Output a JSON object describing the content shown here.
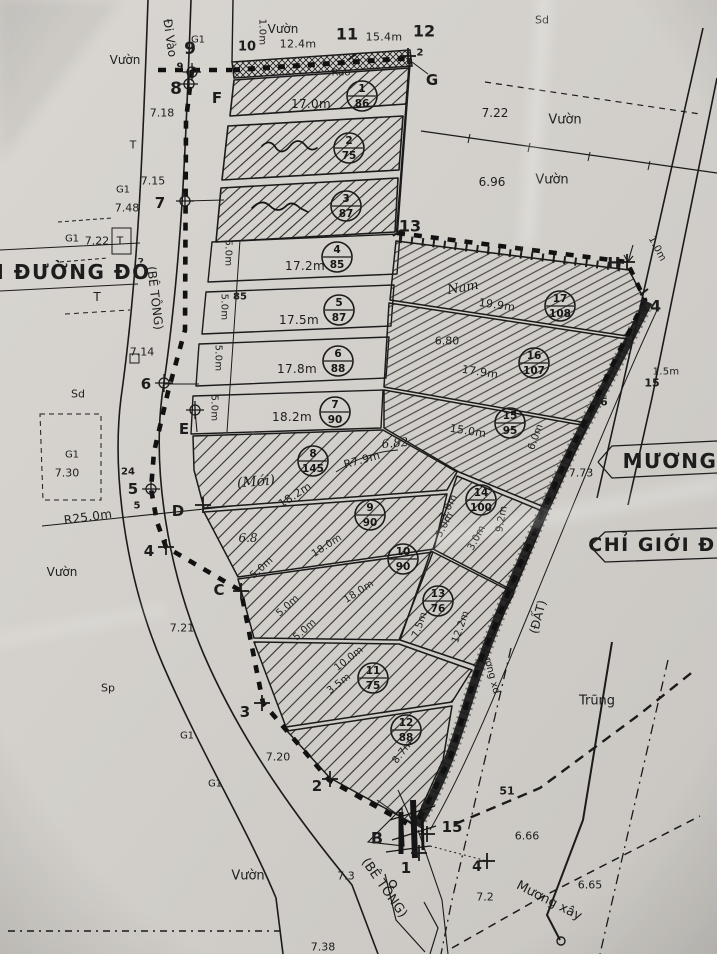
{
  "map": {
    "ink": "#1b1b1b",
    "paper": "#d3d0cb",
    "plots": [
      {
        "n": "1",
        "a": "86",
        "x": 362,
        "y": 96
      },
      {
        "n": "2",
        "a": "75",
        "x": 349,
        "y": 148
      },
      {
        "n": "3",
        "a": "87",
        "x": 346,
        "y": 206
      },
      {
        "n": "4",
        "a": "85",
        "x": 337,
        "y": 257
      },
      {
        "n": "5",
        "a": "87",
        "x": 339,
        "y": 310
      },
      {
        "n": "6",
        "a": "88",
        "x": 338,
        "y": 361
      },
      {
        "n": "7",
        "a": "90",
        "x": 335,
        "y": 412
      },
      {
        "n": "8",
        "a": "145",
        "x": 313,
        "y": 461
      },
      {
        "n": "9",
        "a": "90",
        "x": 370,
        "y": 515
      },
      {
        "n": "10",
        "a": "90",
        "x": 403,
        "y": 559
      },
      {
        "n": "11",
        "a": "75",
        "x": 373,
        "y": 678
      },
      {
        "n": "12",
        "a": "88",
        "x": 406,
        "y": 730
      },
      {
        "n": "13",
        "a": "76",
        "x": 438,
        "y": 601
      },
      {
        "n": "14",
        "a": "100",
        "x": 481,
        "y": 500
      },
      {
        "n": "15",
        "a": "95",
        "x": 510,
        "y": 423
      },
      {
        "n": "16",
        "a": "107",
        "x": 534,
        "y": 363
      },
      {
        "n": "17",
        "a": "108",
        "x": 560,
        "y": 306
      }
    ],
    "labels": [
      {
        "t": "9",
        "x": 190,
        "y": 49,
        "s": 17,
        "c": "pt"
      },
      {
        "t": "8",
        "x": 176,
        "y": 89,
        "s": 17,
        "c": "pt"
      },
      {
        "t": "F",
        "x": 217,
        "y": 98,
        "s": 15,
        "c": "pt"
      },
      {
        "t": "10",
        "x": 247,
        "y": 47,
        "s": 13,
        "c": "pt"
      },
      {
        "t": "11",
        "x": 347,
        "y": 34,
        "s": 16,
        "c": "pt"
      },
      {
        "t": "12",
        "x": 424,
        "y": 31,
        "s": 16,
        "c": "pt"
      },
      {
        "t": "G",
        "x": 432,
        "y": 80,
        "s": 15,
        "c": "pt"
      },
      {
        "t": "13",
        "x": 410,
        "y": 226,
        "s": 16,
        "c": "pt"
      },
      {
        "t": "H",
        "x": 614,
        "y": 263,
        "s": 16,
        "c": "pt"
      },
      {
        "t": "14",
        "x": 650,
        "y": 306,
        "s": 16,
        "c": "pt"
      },
      {
        "t": "7",
        "x": 160,
        "y": 203,
        "s": 15,
        "c": "pt"
      },
      {
        "t": "6",
        "x": 146,
        "y": 384,
        "s": 15,
        "c": "pt"
      },
      {
        "t": "E",
        "x": 184,
        "y": 429,
        "s": 15,
        "c": "pt"
      },
      {
        "t": "5",
        "x": 133,
        "y": 489,
        "s": 15,
        "c": "pt"
      },
      {
        "t": "D",
        "x": 178,
        "y": 511,
        "s": 15,
        "c": "pt"
      },
      {
        "t": "4",
        "x": 149,
        "y": 551,
        "s": 15,
        "c": "pt"
      },
      {
        "t": "C",
        "x": 219,
        "y": 590,
        "s": 15,
        "c": "pt"
      },
      {
        "t": "3",
        "x": 245,
        "y": 712,
        "s": 15,
        "c": "pt"
      },
      {
        "t": "2",
        "x": 317,
        "y": 786,
        "s": 15,
        "c": "pt"
      },
      {
        "t": "B",
        "x": 377,
        "y": 838,
        "s": 16,
        "c": "pt"
      },
      {
        "t": "1",
        "x": 406,
        "y": 868,
        "s": 15,
        "c": "pt"
      },
      {
        "t": "15",
        "x": 452,
        "y": 827,
        "s": 15,
        "c": "pt"
      },
      {
        "t": "4",
        "x": 477,
        "y": 867,
        "s": 14,
        "c": "pt"
      },
      {
        "t": "9",
        "x": 180,
        "y": 67,
        "s": 10,
        "c": "sm"
      },
      {
        "t": "2",
        "x": 420,
        "y": 53,
        "s": 10,
        "c": "sm"
      },
      {
        "t": "5",
        "x": 137,
        "y": 506,
        "s": 10,
        "c": "sm"
      },
      {
        "t": "24",
        "x": 128,
        "y": 472,
        "s": 10,
        "c": "sm"
      },
      {
        "t": "85",
        "x": 240,
        "y": 297,
        "s": 10,
        "c": "sm"
      },
      {
        "t": "51",
        "x": 507,
        "y": 791,
        "s": 11,
        "c": "sm"
      },
      {
        "t": "15",
        "x": 652,
        "y": 383,
        "s": 11,
        "c": "sm"
      },
      {
        "t": "66",
        "x": 600,
        "y": 402,
        "s": 11,
        "c": "sm"
      },
      {
        "t": "Vườn",
        "x": 125,
        "y": 60,
        "s": 12,
        "c": "name"
      },
      {
        "t": "Vườn",
        "x": 283,
        "y": 29,
        "s": 12,
        "c": "name"
      },
      {
        "t": "Vườn",
        "x": 565,
        "y": 120,
        "s": 13,
        "c": "name"
      },
      {
        "t": "Vườn",
        "x": 552,
        "y": 180,
        "s": 13,
        "c": "name"
      },
      {
        "t": "Vườn",
        "x": 62,
        "y": 572,
        "s": 12,
        "c": "name"
      },
      {
        "t": "Vườn",
        "x": 248,
        "y": 876,
        "s": 13,
        "c": "name"
      },
      {
        "t": "Trũng",
        "x": 597,
        "y": 701,
        "s": 13,
        "c": "name"
      },
      {
        "t": "Sd",
        "x": 542,
        "y": 20,
        "s": 11,
        "c": "name"
      },
      {
        "t": "Sd",
        "x": 78,
        "y": 394,
        "s": 11,
        "c": "name"
      },
      {
        "t": "Sp",
        "x": 108,
        "y": 688,
        "s": 11,
        "c": "name"
      },
      {
        "t": "Rào",
        "x": 341,
        "y": 73,
        "s": 10,
        "c": "name"
      },
      {
        "t": "G1",
        "x": 198,
        "y": 40,
        "s": 10,
        "c": "name"
      },
      {
        "t": "G1",
        "x": 123,
        "y": 190,
        "s": 10,
        "c": "name"
      },
      {
        "t": "G1",
        "x": 72,
        "y": 239,
        "s": 10,
        "c": "name"
      },
      {
        "t": "G1",
        "x": 72,
        "y": 455,
        "s": 10,
        "c": "name"
      },
      {
        "t": "G1",
        "x": 187,
        "y": 736,
        "s": 10,
        "c": "name"
      },
      {
        "t": "G1",
        "x": 215,
        "y": 784,
        "s": 10,
        "c": "name"
      },
      {
        "t": "T",
        "x": 133,
        "y": 145,
        "s": 11,
        "c": "name"
      },
      {
        "t": "T",
        "x": 120,
        "y": 241,
        "s": 11,
        "c": "name"
      },
      {
        "t": "T",
        "x": 97,
        "y": 297,
        "s": 12,
        "c": "name"
      },
      {
        "t": "Đi Vào",
        "x": 170,
        "y": 38,
        "s": 12,
        "r": 82,
        "c": "name"
      },
      {
        "t": "(BÊ TÔNG)",
        "x": 155,
        "y": 298,
        "s": 12,
        "r": 83,
        "c": "name"
      },
      {
        "t": "Mương xd",
        "x": 490,
        "y": 670,
        "s": 10,
        "r": 75,
        "c": "name"
      },
      {
        "t": "(ĐẤT)",
        "x": 538,
        "y": 617,
        "s": 12,
        "r": -75,
        "c": "name"
      },
      {
        "t": "Mương xây",
        "x": 549,
        "y": 901,
        "s": 13,
        "r": 27,
        "c": "name"
      },
      {
        "t": "(BÊ TÔNG)",
        "x": 384,
        "y": 888,
        "s": 13,
        "r": 55,
        "c": "name"
      },
      {
        "t": "ỚI ĐƯỜNG ĐỎ",
        "x": 64,
        "y": 272,
        "s": 20,
        "c": "big"
      },
      {
        "t": "MƯƠNG",
        "x": 670,
        "y": 461,
        "s": 20,
        "c": "big"
      },
      {
        "t": "CHỈ GIỚI Đ",
        "x": 652,
        "y": 545,
        "s": 19,
        "c": "big"
      },
      {
        "t": "7.18",
        "x": 162,
        "y": 113,
        "s": 11,
        "c": "elev"
      },
      {
        "t": "7.15",
        "x": 153,
        "y": 181,
        "s": 11,
        "c": "elev"
      },
      {
        "t": "7.48",
        "x": 127,
        "y": 208,
        "s": 11,
        "c": "elev"
      },
      {
        "t": "7.22",
        "x": 97,
        "y": 241,
        "s": 11,
        "c": "elev"
      },
      {
        "t": "7.14",
        "x": 142,
        "y": 352,
        "s": 11,
        "c": "elev"
      },
      {
        "t": "7.30",
        "x": 67,
        "y": 473,
        "s": 11,
        "c": "elev"
      },
      {
        "t": "7.21",
        "x": 182,
        "y": 628,
        "s": 11,
        "c": "elev"
      },
      {
        "t": "7.20",
        "x": 278,
        "y": 757,
        "s": 11,
        "c": "elev"
      },
      {
        "t": "7.22",
        "x": 495,
        "y": 113,
        "s": 12,
        "c": "elev"
      },
      {
        "t": "6.96",
        "x": 492,
        "y": 182,
        "s": 12,
        "c": "elev"
      },
      {
        "t": "6.80",
        "x": 447,
        "y": 341,
        "s": 11,
        "c": "elev"
      },
      {
        "t": "7.73",
        "x": 581,
        "y": 473,
        "s": 11,
        "c": "elev"
      },
      {
        "t": "6.66",
        "x": 527,
        "y": 836,
        "s": 11,
        "c": "elev"
      },
      {
        "t": "6.65",
        "x": 590,
        "y": 885,
        "s": 11,
        "c": "elev"
      },
      {
        "t": "7.2",
        "x": 485,
        "y": 897,
        "s": 11,
        "c": "elev"
      },
      {
        "t": "7.3",
        "x": 346,
        "y": 876,
        "s": 11,
        "c": "elev"
      },
      {
        "t": "7.38",
        "x": 323,
        "y": 947,
        "s": 11,
        "c": "elev"
      },
      {
        "t": "1.0m",
        "x": 262,
        "y": 32,
        "s": 10,
        "r": 90,
        "c": "dim"
      },
      {
        "t": "12.4m",
        "x": 298,
        "y": 44,
        "s": 11,
        "c": "dim"
      },
      {
        "t": "15.4m",
        "x": 384,
        "y": 37,
        "s": 11,
        "c": "dim"
      },
      {
        "t": "17.0m",
        "x": 311,
        "y": 104,
        "s": 12,
        "c": "dim"
      },
      {
        "t": "17.2m",
        "x": 305,
        "y": 266,
        "s": 12,
        "c": "dim"
      },
      {
        "t": "17.5m",
        "x": 299,
        "y": 320,
        "s": 12,
        "c": "dim"
      },
      {
        "t": "17.8m",
        "x": 297,
        "y": 369,
        "s": 12,
        "c": "dim"
      },
      {
        "t": "18.2m",
        "x": 292,
        "y": 417,
        "s": 12,
        "c": "dim"
      },
      {
        "t": "5.0m",
        "x": 228,
        "y": 253,
        "s": 10,
        "r": 90,
        "c": "dim"
      },
      {
        "t": "5.0m",
        "x": 224,
        "y": 307,
        "s": 10,
        "r": 90,
        "c": "dim"
      },
      {
        "t": "5.0m",
        "x": 218,
        "y": 358,
        "s": 10,
        "r": 90,
        "c": "dim"
      },
      {
        "t": "5.0m",
        "x": 214,
        "y": 408,
        "s": 10,
        "r": 90,
        "c": "dim"
      },
      {
        "t": "19.9m",
        "x": 497,
        "y": 305,
        "s": 11,
        "r": 8,
        "c": "dim"
      },
      {
        "t": "17.9m",
        "x": 480,
        "y": 372,
        "s": 11,
        "r": 9,
        "c": "dim"
      },
      {
        "t": "15.0m",
        "x": 468,
        "y": 431,
        "s": 11,
        "r": 9,
        "c": "dim"
      },
      {
        "t": "6.0m",
        "x": 536,
        "y": 437,
        "s": 10,
        "r": -70,
        "c": "dim"
      },
      {
        "t": "1.0m",
        "x": 657,
        "y": 249,
        "s": 10,
        "r": 62,
        "c": "dim"
      },
      {
        "t": "1.5m",
        "x": 666,
        "y": 372,
        "s": 10,
        "c": "dim"
      },
      {
        "t": "18.2m",
        "x": 295,
        "y": 495,
        "s": 11,
        "r": -33,
        "c": "dim"
      },
      {
        "t": "R7.9m",
        "x": 362,
        "y": 460,
        "s": 11,
        "r": -15,
        "c": "dim"
      },
      {
        "t": "18.0m",
        "x": 327,
        "y": 546,
        "s": 10,
        "r": -33,
        "c": "dim"
      },
      {
        "t": "18.0m",
        "x": 359,
        "y": 592,
        "s": 10,
        "r": -33,
        "c": "dim"
      },
      {
        "t": "10.0m",
        "x": 349,
        "y": 659,
        "s": 10,
        "r": -38,
        "c": "dim"
      },
      {
        "t": "3.5m",
        "x": 339,
        "y": 684,
        "s": 10,
        "r": -38,
        "c": "dim"
      },
      {
        "t": "5.0m",
        "x": 262,
        "y": 568,
        "s": 10,
        "r": -42,
        "c": "dim"
      },
      {
        "t": "5.0m",
        "x": 288,
        "y": 606,
        "s": 10,
        "r": -42,
        "c": "dim"
      },
      {
        "t": "5.0m",
        "x": 305,
        "y": 630,
        "s": 10,
        "r": -42,
        "c": "dim"
      },
      {
        "t": "3.0m",
        "x": 449,
        "y": 507,
        "s": 10,
        "r": -62,
        "c": "dim"
      },
      {
        "t": "5.0m",
        "x": 445,
        "y": 525,
        "s": 10,
        "r": -62,
        "c": "dim"
      },
      {
        "t": "3.0m",
        "x": 477,
        "y": 538,
        "s": 10,
        "r": -62,
        "c": "dim"
      },
      {
        "t": "9.2m",
        "x": 502,
        "y": 519,
        "s": 10,
        "r": -80,
        "c": "dim"
      },
      {
        "t": "7.5m",
        "x": 420,
        "y": 625,
        "s": 10,
        "r": -70,
        "c": "dim"
      },
      {
        "t": "12.2m",
        "x": 461,
        "y": 627,
        "s": 10,
        "r": -70,
        "c": "dim"
      },
      {
        "t": "8.7m",
        "x": 403,
        "y": 752,
        "s": 10,
        "r": -52,
        "c": "dim"
      },
      {
        "t": "R25.0m",
        "x": 88,
        "y": 517,
        "s": 12,
        "r": -8,
        "c": "dim"
      },
      {
        "t": "(Mới)",
        "x": 256,
        "y": 482,
        "s": 14,
        "r": -5,
        "c": "hand"
      },
      {
        "t": "Nam",
        "x": 463,
        "y": 288,
        "s": 13,
        "r": -10,
        "c": "hand"
      },
      {
        "t": "6.82",
        "x": 395,
        "y": 443,
        "s": 12,
        "r": -5,
        "c": "hand"
      },
      {
        "t": "6.8",
        "x": 248,
        "y": 538,
        "s": 12,
        "c": "hand"
      }
    ],
    "markers": [
      {
        "type": "cc",
        "x": 192,
        "y": 72
      },
      {
        "type": "cc",
        "x": 189,
        "y": 84
      },
      {
        "type": "cc",
        "x": 185,
        "y": 201
      },
      {
        "type": "cc",
        "x": 164,
        "y": 383
      },
      {
        "type": "cc",
        "x": 151,
        "y": 489
      },
      {
        "type": "cc",
        "x": 195,
        "y": 410
      },
      {
        "type": "plus",
        "x": 203,
        "y": 505
      },
      {
        "type": "plus",
        "x": 166,
        "y": 547
      },
      {
        "type": "plus",
        "x": 241,
        "y": 591
      },
      {
        "type": "plus",
        "x": 262,
        "y": 703
      },
      {
        "type": "plus",
        "x": 330,
        "y": 779
      },
      {
        "type": "plus",
        "x": 419,
        "y": 853
      },
      {
        "type": "plus",
        "x": 427,
        "y": 834
      },
      {
        "type": "plus",
        "x": 487,
        "y": 861
      },
      {
        "type": "plus",
        "x": 627,
        "y": 262
      },
      {
        "type": "plus",
        "x": 408,
        "y": 56
      },
      {
        "type": "tick",
        "x": 397,
        "y": 233
      },
      {
        "type": "tick",
        "x": 644,
        "y": 292
      },
      {
        "type": "tick",
        "x": 352,
        "y": 57
      }
    ]
  }
}
